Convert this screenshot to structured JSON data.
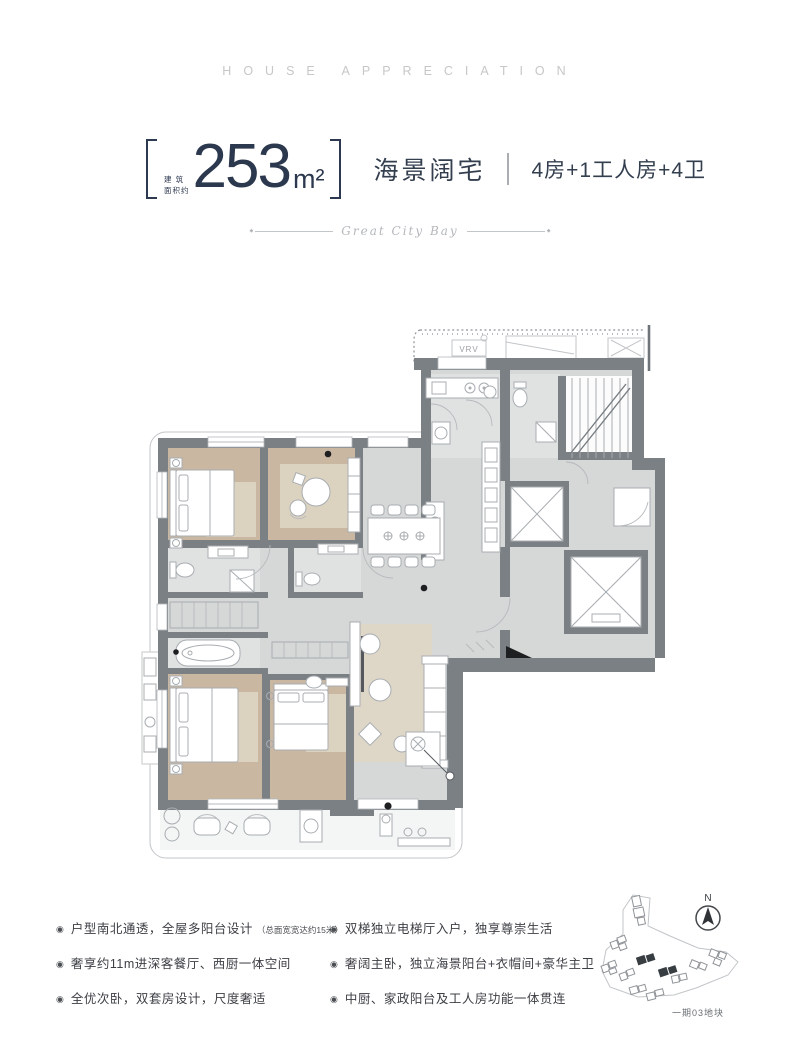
{
  "masthead": {
    "text": "HOUSE APPRECIATION"
  },
  "header": {
    "area_prefix_line1": "建 筑",
    "area_prefix_line2": "面积约",
    "area_value": "253",
    "area_unit": "m²",
    "title": "海景阔宅",
    "subtitle": "4房+1工人房+4卫",
    "accent_color": "#2d3950"
  },
  "tagline": {
    "script_text": "Great City Bay",
    "end_mark": "◆"
  },
  "floorplan": {
    "vrv_label": "VRV",
    "colors": {
      "wall": "#7b8085",
      "floor": "#d6d7d7",
      "wood_floor": "#c9b7a2",
      "rug": "#dcd2c0",
      "tile": "#e0e2e2"
    }
  },
  "features": {
    "bullet": "◉",
    "left": [
      {
        "text": "户型南北通透，全屋多阳台设计",
        "note": "（总面宽宽达约15米）"
      },
      {
        "text": "奢享约11m进深客餐厅、西厨一体空间",
        "note": ""
      },
      {
        "text": "全优次卧，双套房设计，尺度奢适",
        "note": ""
      }
    ],
    "right": [
      {
        "text": "双梯独立电梯厅入户，独享尊崇生活"
      },
      {
        "text": "奢阔主卧，独立海景阳台+衣帽间+豪华主卫"
      },
      {
        "text": "中厨、家政阳台及工人房功能一体贯连"
      }
    ]
  },
  "sitemap": {
    "north_label": "N",
    "plot_label": "一期03地块"
  }
}
